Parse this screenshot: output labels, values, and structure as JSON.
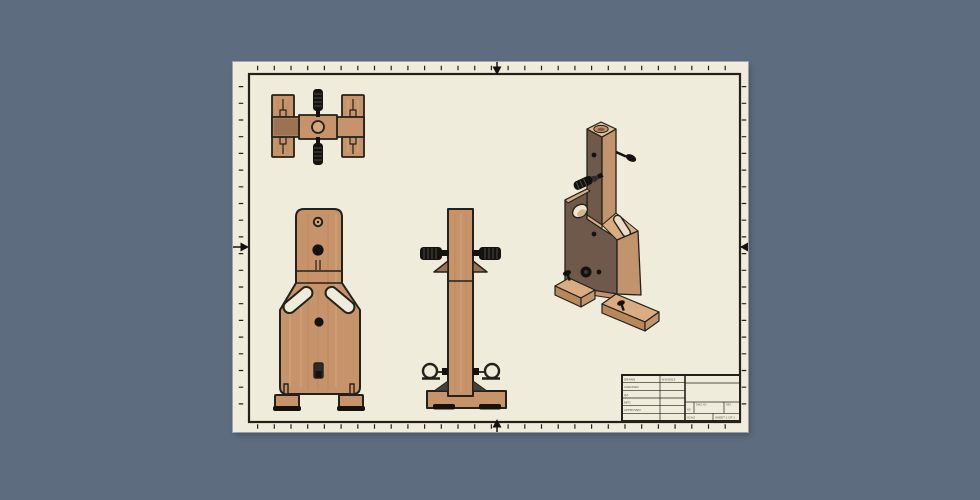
{
  "colors": {
    "bg": "#5E6C80",
    "sheet": "#EFECDC",
    "line": "#23211A",
    "wood": "#C6936A",
    "wood_light": "#D5A87C",
    "wood_dark": "#9C7350",
    "iso_front": "#6E594B",
    "iso_side": "#C2946D",
    "iso_top": "#E3BE97",
    "iso_edge": "#D9AC81",
    "hardware": "#15120E"
  },
  "title_block": {
    "rows": [
      {
        "label": "DRAWN",
        "value": "8/16/2013"
      },
      {
        "label": "CHECKED",
        "value": ""
      },
      {
        "label": "QA",
        "value": ""
      },
      {
        "label": "MFG",
        "value": ""
      },
      {
        "label": "APPROVED",
        "value": ""
      }
    ],
    "title": "",
    "size": "A2",
    "dwg_no": "DWG NO",
    "rev": "REV",
    "scale": "SCALE",
    "sheet": "SHEET 1 OF 1"
  }
}
